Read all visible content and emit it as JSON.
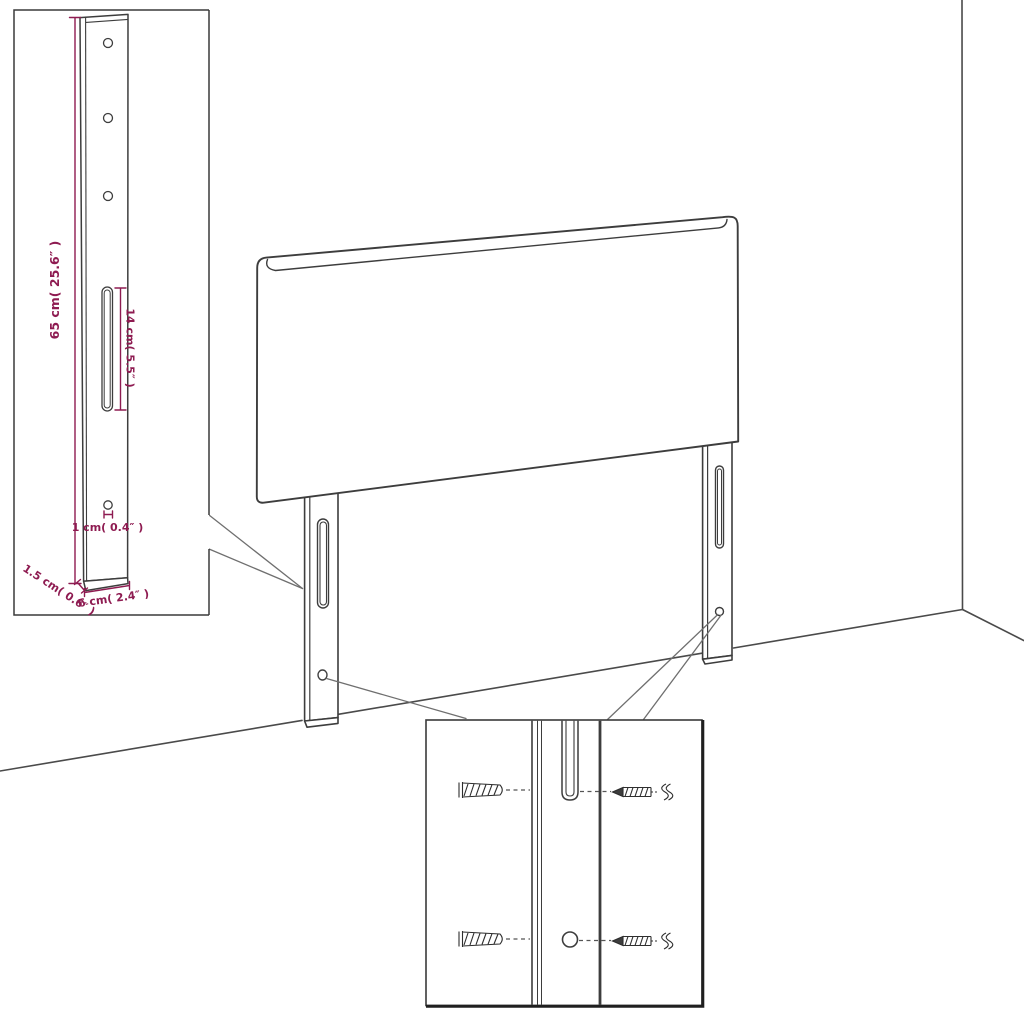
{
  "canvas": {
    "width": 1024,
    "height": 1024,
    "background": "#ffffff"
  },
  "palette": {
    "outline_color": "#3d3d3d",
    "inset_border_color": "#3a3a3a",
    "callout_line_color": "#6f6f6f",
    "dimension_color": "#8e1b51"
  },
  "main_view": {
    "subject": "headboard-with-two-mounting-legs-in-room-corner",
    "parts": [
      "headboard-panel",
      "left-mounting-leg",
      "right-mounting-leg",
      "wall-corner",
      "floor-line"
    ]
  },
  "dimension_inset": {
    "subject": "mounting-leg-side-detail",
    "labels": {
      "leg_height": "65 cm( 25.6″ )",
      "slot_length": "14 cm( 5.5″ )",
      "hole_diameter": "1 cm( 0.4″ )",
      "side_thickness": "1.5 cm( 0.6″ )",
      "leg_width": "6 cm( 2.4″ )"
    }
  },
  "hardware_inset": {
    "subject": "wall-fixing-detail",
    "components": [
      "wall-plug-top",
      "wall-plug-bottom",
      "screw-top",
      "screw-bottom",
      "keyhole-slot",
      "screw-hole"
    ]
  }
}
